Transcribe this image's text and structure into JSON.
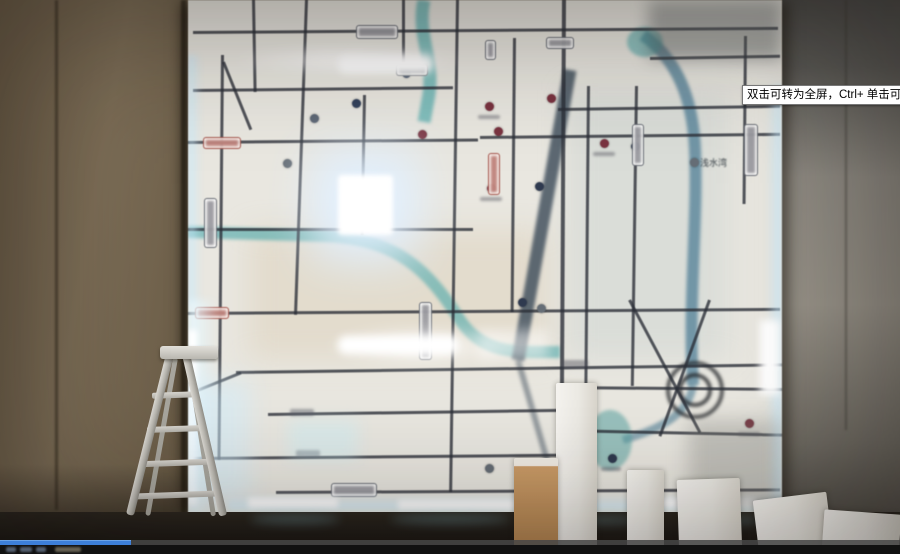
{
  "video_player": {
    "tooltip_text": "双击可转为全屏，Ctrl+ 单击可转为",
    "progress_percent": 14.5,
    "progress_color": "#3d7fd9"
  },
  "scene": {
    "map_visible_label": "浅水湾"
  },
  "colors": {
    "led_glow": "#cfeeff",
    "river_teal": "#4aa7a9",
    "road_dark": "#2c3038",
    "wall_brown": "#75664f",
    "wall_gray": "#8e8a82"
  }
}
